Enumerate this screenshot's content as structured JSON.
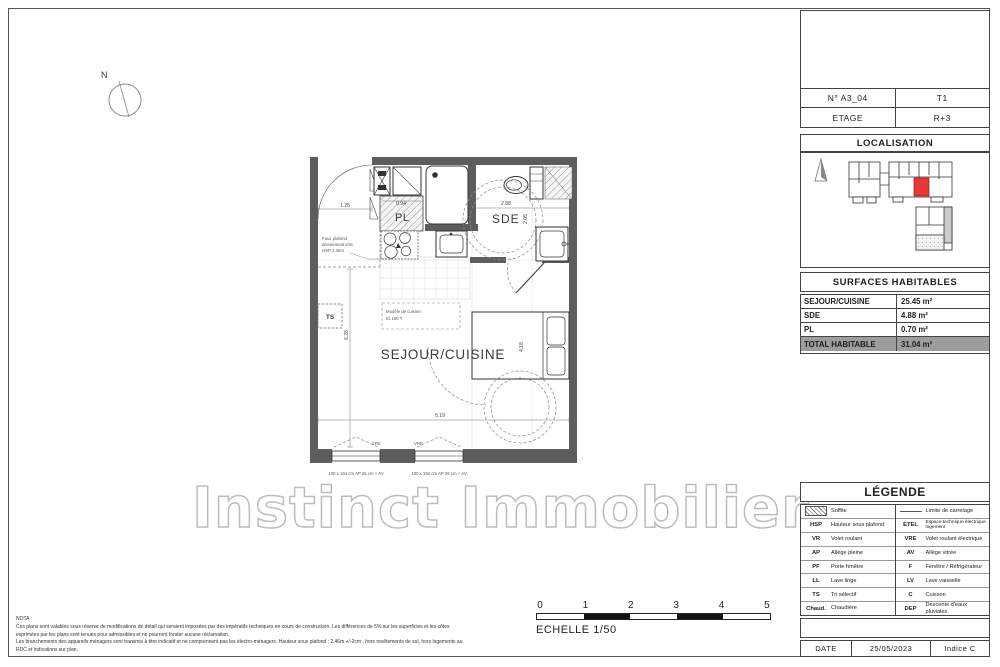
{
  "colors": {
    "wall": "#5d5d5d",
    "red_unit": "#e53935",
    "total_row_bg": "#9d9d9d",
    "watermark_stroke": "#bdbdbd"
  },
  "watermark": "Instinct Immobilier",
  "north_label": "N",
  "plan": {
    "rooms": {
      "sejour": "SEJOUR/CUISINE",
      "sde": "SDE",
      "pl": "PL",
      "ts": "TS"
    },
    "dimensions": {
      "entry": "1.25",
      "pl_width": "0.94",
      "sde_width": "2.88",
      "sde_height": "2.05",
      "room_length": "6.28",
      "bed_wall": "4.18",
      "room_width": "5.19"
    },
    "annotations": {
      "faux_plafond": [
        "Faux plafond",
        "dévoiement vmc",
        "HSP 2.30m"
      ],
      "cuisine": [
        "Modèle de cuisine:",
        "tcl 180 T"
      ],
      "vre": "VRE",
      "window_spec": "100 x 194 cm  AP 26 cm + AV"
    }
  },
  "scale_bar": {
    "ticks": [
      "0",
      "1",
      "2",
      "3",
      "4",
      "5"
    ],
    "label": "ECHELLE 1/50"
  },
  "nota": {
    "lines": [
      "NOTA :",
      "Ces plans sont valables sous réserve de modifications de détail qui seraient imposées par des impératifs techniques en cours de construction. Les différences de 5% sur les superficies et les côtes",
      "exprimées par les plans sont tenues pour admissibles et ne pourront fonder aucune réclamation.",
      "Les branchements des appareils ménagers sont transmis à titre indicatif et ne comprennent pas les électro-ménagers. Hauteur sous plafond : 2.46m +/-2cm , hors revêtements de sol, hors logements au",
      "RDC et indications sur plan."
    ]
  },
  "title_block": {
    "unit_number": "N° A3_04",
    "unit_type": "T1",
    "floor_label": "ETAGE",
    "floor_value": "R+3",
    "localisation_title": "LOCALISATION",
    "surfaces_title": "SURFACES HABITABLES",
    "surfaces": {
      "rows": [
        {
          "label": "SEJOUR/CUISINE",
          "value": "25.45 m²"
        },
        {
          "label": "SDE",
          "value": "4.88 m²"
        },
        {
          "label": "PL",
          "value": "0.70 m²"
        }
      ],
      "total": {
        "label": "TOTAL HABITABLE",
        "value": "31.04 m²"
      }
    },
    "legend_title": "LÉGENDE",
    "legend_left": [
      {
        "abbr": "",
        "label": "Soffite"
      },
      {
        "abbr": "HSP",
        "label": "Hauteur sous plafond"
      },
      {
        "abbr": "VR",
        "label": "Volet roulant"
      },
      {
        "abbr": "AP",
        "label": "Allège pleine"
      },
      {
        "abbr": "PF",
        "label": "Porte fenêtre"
      },
      {
        "abbr": "LL",
        "label": "Lave linge"
      },
      {
        "abbr": "TS",
        "label": "Tri sélectif"
      },
      {
        "abbr": "Chaud.",
        "label": "Chaudière"
      }
    ],
    "legend_right": [
      {
        "abbr": "",
        "label": "Limite de carrelage"
      },
      {
        "abbr": "ETEL",
        "label": "Espace technique électrique logement"
      },
      {
        "abbr": "VRE",
        "label": "Volet roulant électrique"
      },
      {
        "abbr": "AV",
        "label": "Allège vitrée"
      },
      {
        "abbr": "F",
        "label": "Fenêtre / Réfrigérateur"
      },
      {
        "abbr": "LV",
        "label": "Lave vaisselle"
      },
      {
        "abbr": "C",
        "label": "Cuisson"
      },
      {
        "abbr": "DEP",
        "label": "Descente d'eaux pluviales"
      }
    ],
    "date_label": "DATE",
    "date_value": "25/05/2023",
    "indice": "Indice C"
  }
}
